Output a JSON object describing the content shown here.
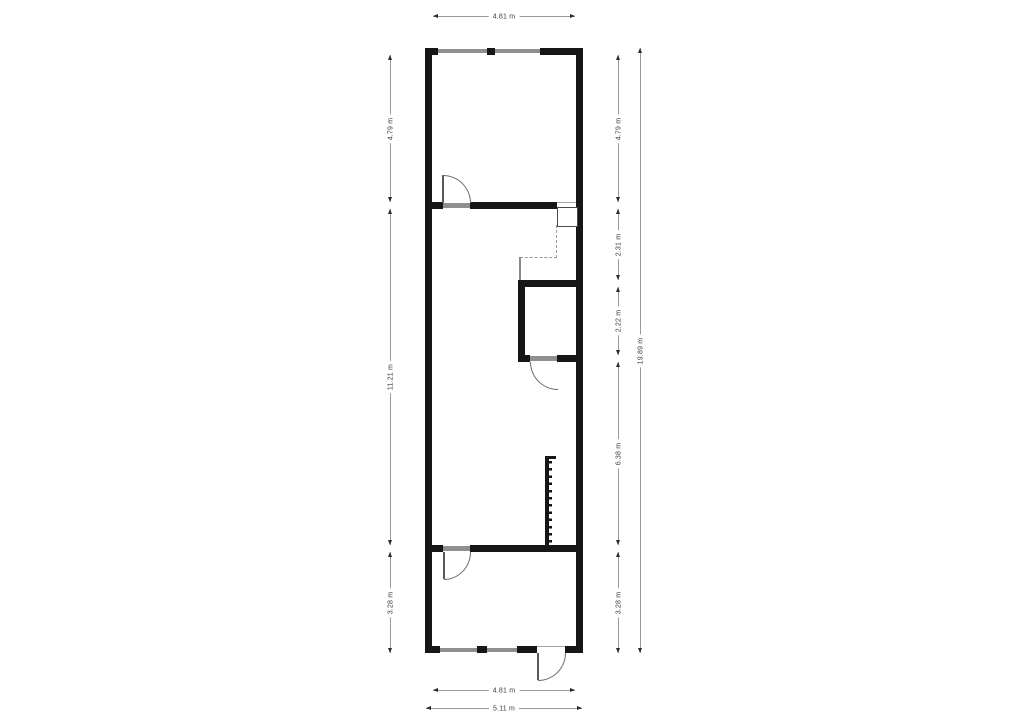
{
  "title": "Floor plan",
  "units": "m",
  "dimensions": {
    "top_width": "4.81 m",
    "bottom_width_inner": "4.81 m",
    "bottom_width_outer": "5.11 m",
    "left_heights": [
      "4.79 m",
      "11.21 m",
      "3.28 m"
    ],
    "right_heights": [
      "4.79 m",
      "2.31 m",
      "2.22 m",
      "6.38 m",
      "3.28 m"
    ],
    "right_total_height": "19.89 m"
  },
  "colors": {
    "wall": "#161616",
    "window": "#8f8f8f",
    "door_leaf": "#8f8f8f",
    "door_arc": "#6b6b6b",
    "dashed_line": "#9a9a9a",
    "dimension_line": "#999999",
    "dimension_text": "#3a3a3a",
    "background": "#ffffff"
  }
}
